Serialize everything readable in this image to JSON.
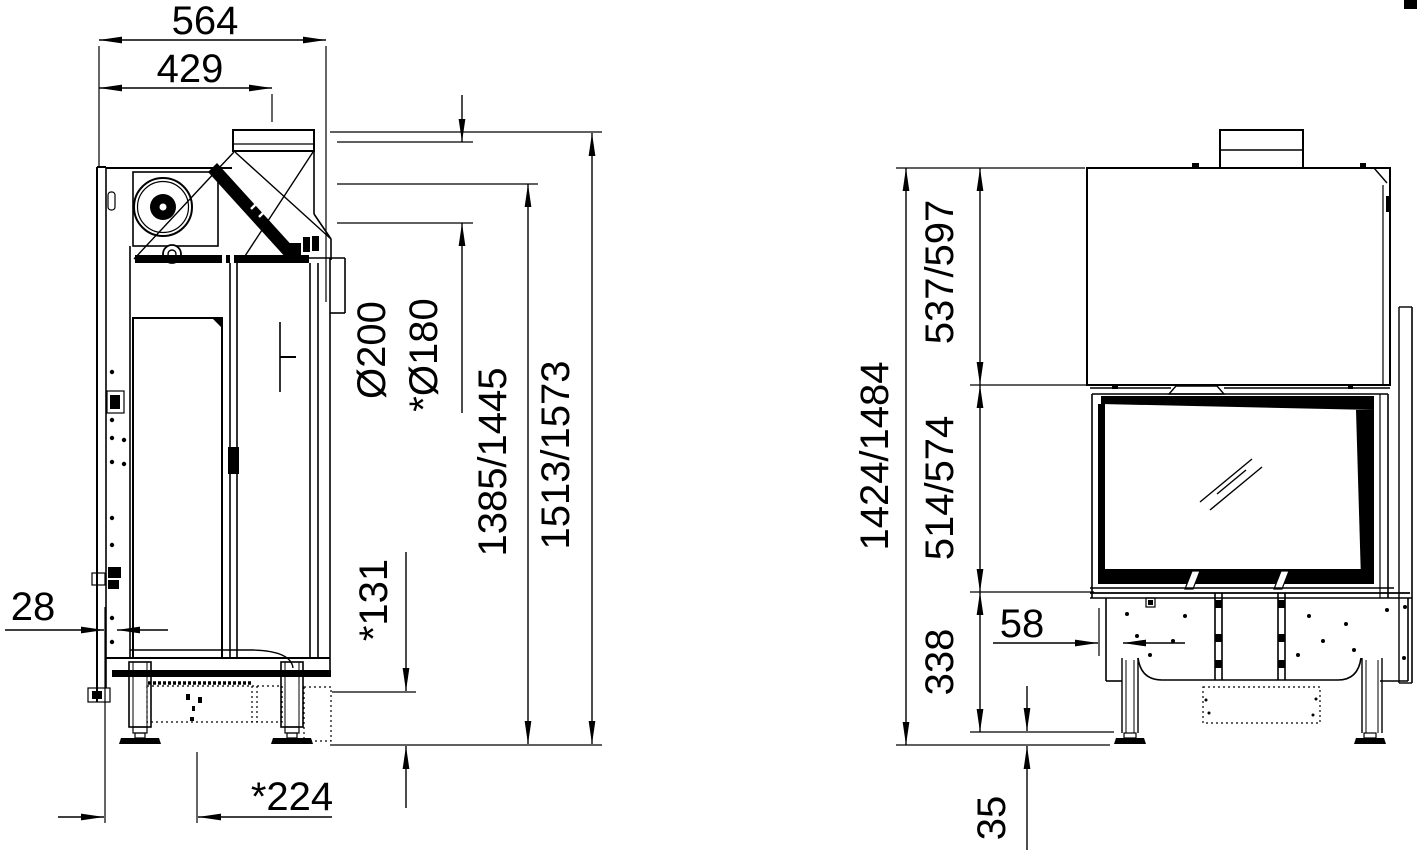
{
  "drawing": {
    "type": "technical-dimension-drawing",
    "line_color": "#000000",
    "background": "#ffffff",
    "side_view": {
      "total_width": "564",
      "top_width": "429",
      "flue_diameter": "Ø200",
      "flue_diameter_alt": "*Ø180",
      "flue_axis_height": "1385/1445",
      "total_height": "1513/1573",
      "bottom_clearance": "*131",
      "rear_offset": "28",
      "leg_center_depth": "*224"
    },
    "front_view": {
      "hood_height": "537/597",
      "door_height": "514/574",
      "total_height": "1424/1484",
      "base_height": "338",
      "front_offset": "58",
      "foot_height": "35"
    }
  }
}
